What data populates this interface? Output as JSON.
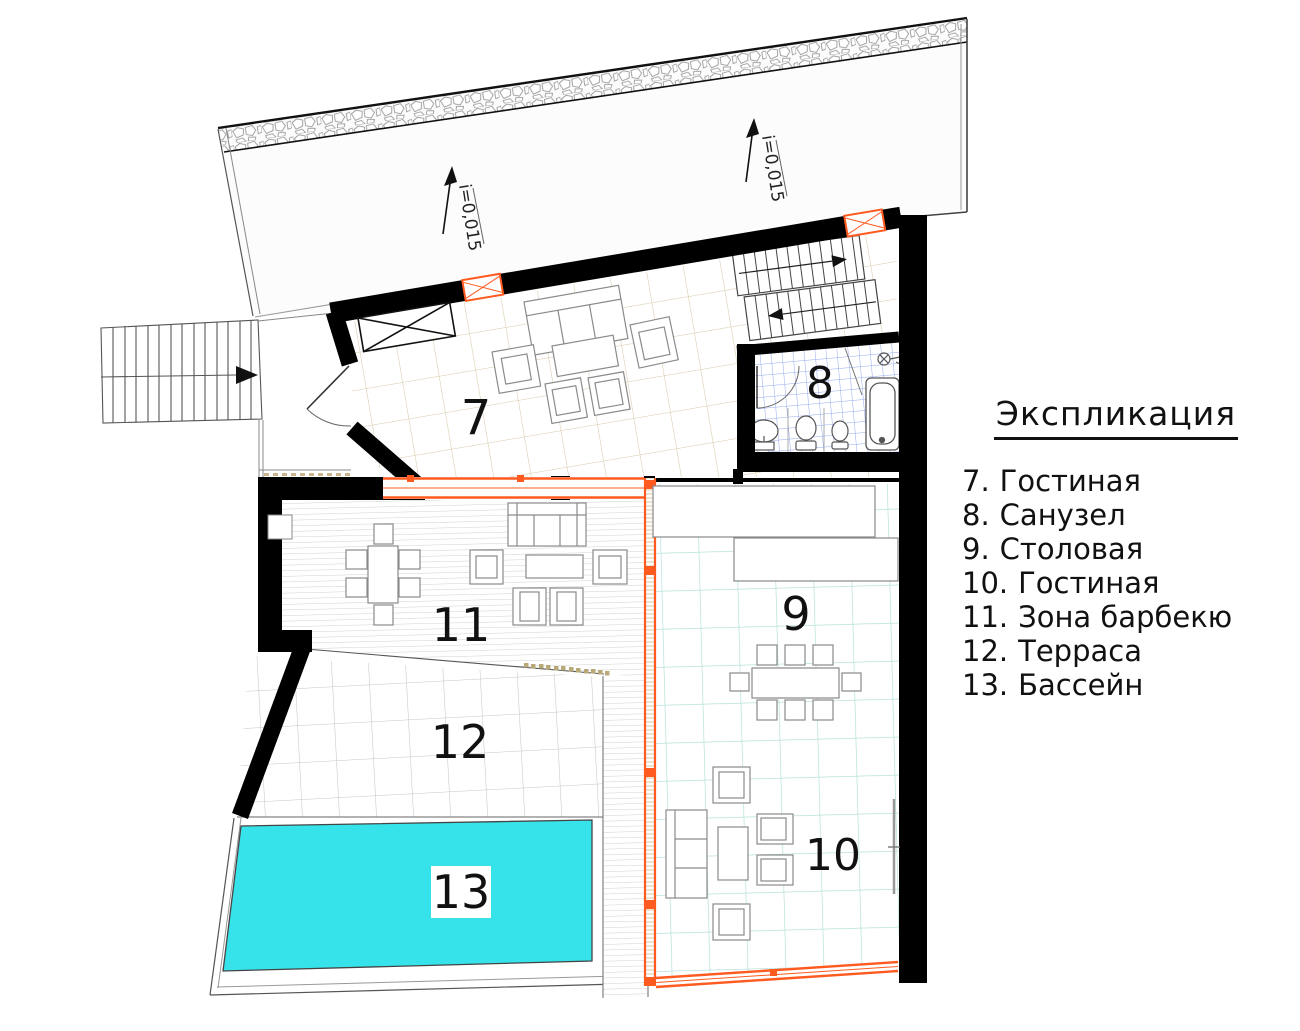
{
  "legend": {
    "title": "Экспликация",
    "items": [
      {
        "num": "7.",
        "label": "Гостиная"
      },
      {
        "num": "8.",
        "label": "Санузел"
      },
      {
        "num": "9.",
        "label": "Столовая"
      },
      {
        "num": "10.",
        "label": "Гостиная"
      },
      {
        "num": "11.",
        "label": "Зона барбекю"
      },
      {
        "num": "12.",
        "label": "Терраса"
      },
      {
        "num": "13.",
        "label": "Бассейн"
      }
    ]
  },
  "rooms": {
    "living7": "7",
    "bath8": "8",
    "dining9": "9",
    "living10": "10",
    "bbq11": "11",
    "terrace12": "12",
    "pool13": "13"
  },
  "annotations": {
    "slope_left": "i=0,015",
    "slope_right": "i=0,015"
  },
  "colors": {
    "wall": "#000000",
    "glazing_orange": "#ff5a1f",
    "pool_cyan": "#36e3ea",
    "tile_tan": "#d9caa9",
    "tile_cyan": "#a9dcd2",
    "tile_blue": "#95aaee",
    "tile_gray": "#c6c6c6"
  }
}
